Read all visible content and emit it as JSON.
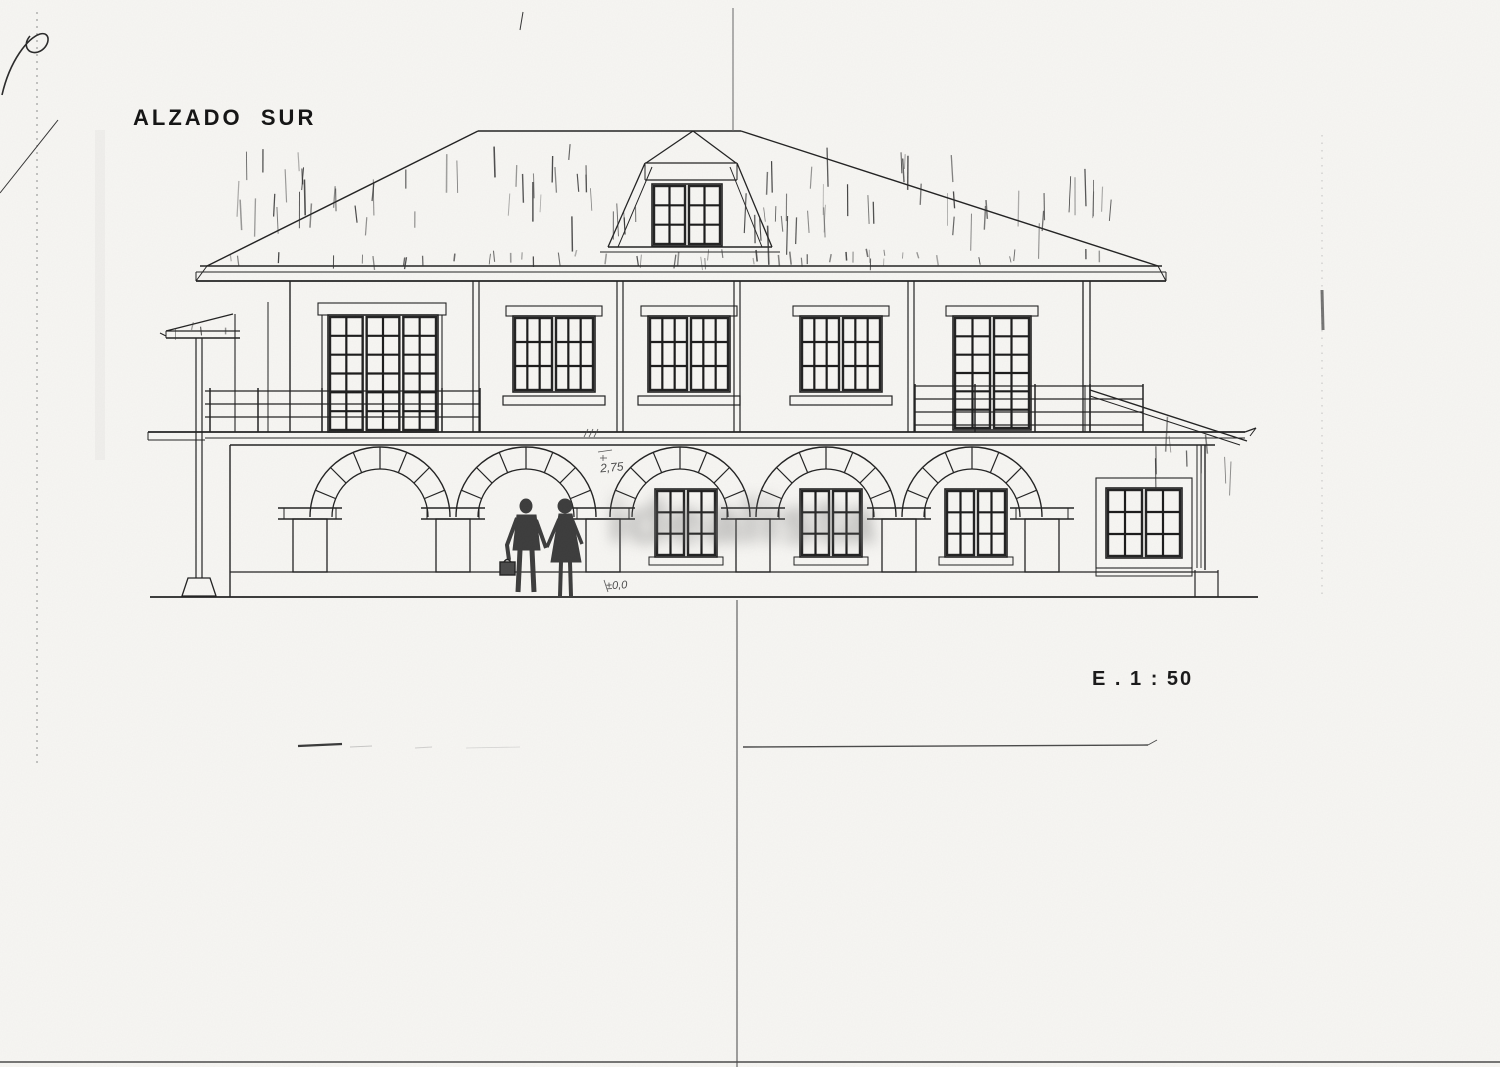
{
  "sheet": {
    "title": "ALZADO  SUR",
    "scale_label": "E . 1 : 50",
    "watermark_text": "idealista",
    "annotations": {
      "mid_level": "2,75",
      "ground_level": "±0,0"
    },
    "colors": {
      "paper": "#f7f6f3",
      "ink": "#222222",
      "watermark": "#6e6e6e"
    }
  }
}
